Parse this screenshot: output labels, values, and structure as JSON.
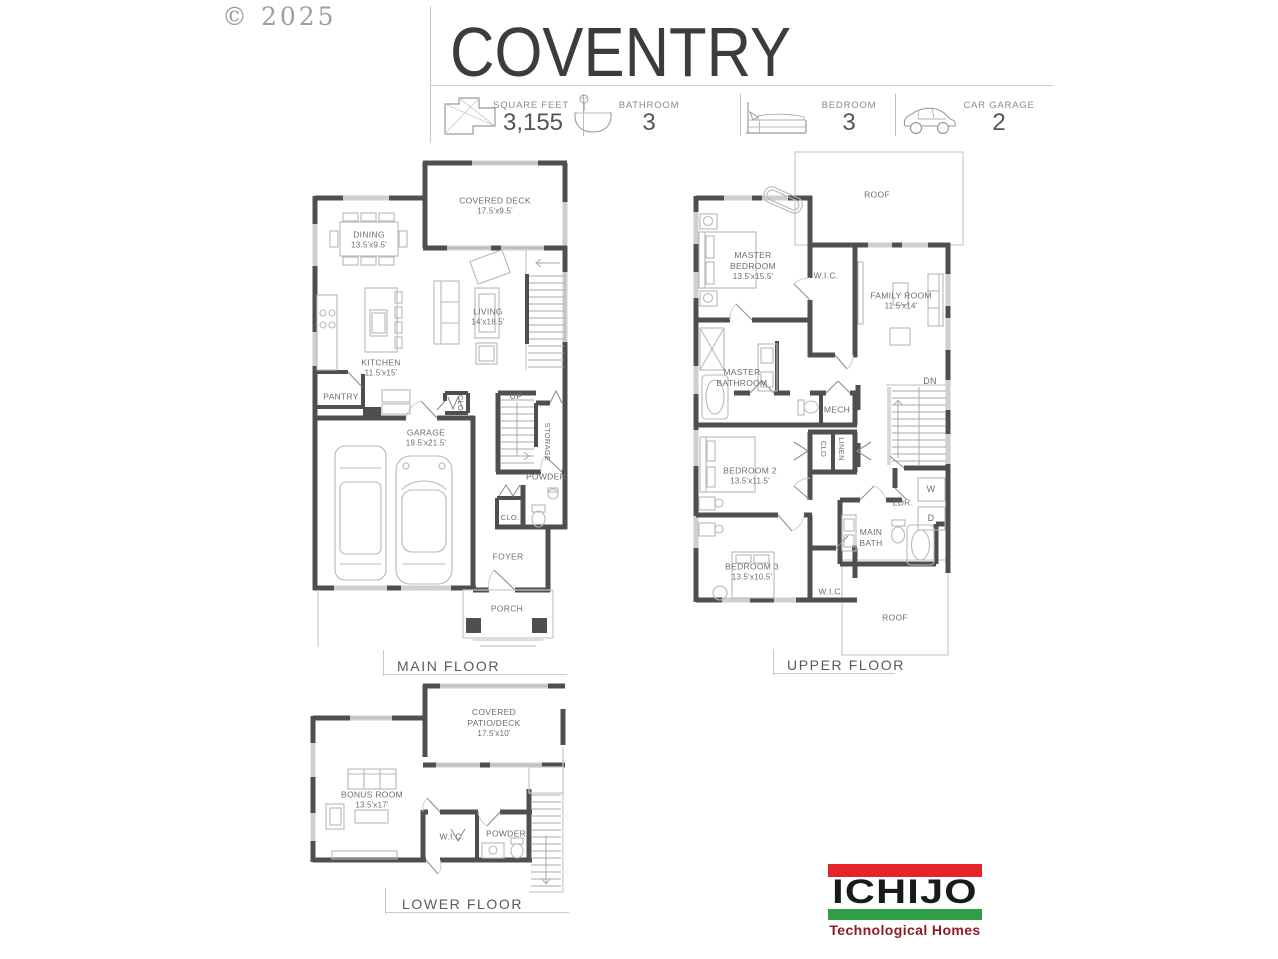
{
  "watermark": "© 2025",
  "header": {
    "title": "COVENTRY",
    "stats": [
      {
        "icon": "floorplan-icon",
        "label": "SQUARE FEET",
        "value": "3,155"
      },
      {
        "icon": "bathtub-icon",
        "label": "BATHROOM",
        "value": "3"
      },
      {
        "icon": "bed-icon",
        "label": "BEDROOM",
        "value": "3"
      },
      {
        "icon": "car-garage-icon",
        "label": "CAR GARAGE",
        "value": "2"
      }
    ]
  },
  "floors": {
    "main": {
      "title": "MAIN FLOOR",
      "rooms": {
        "covered_deck": {
          "name": "COVERED DECK",
          "dims": "17.5'x9.5'"
        },
        "dining": {
          "name": "DINING",
          "dims": "13.5'x9.5'"
        },
        "living": {
          "name": "LIVING",
          "dims": "14'x18.5'"
        },
        "kitchen": {
          "name": "KITCHEN",
          "dims": "11.5'x15'"
        },
        "pantry": {
          "name": "PANTRY"
        },
        "garage": {
          "name": "GARAGE",
          "dims": "19.5'x21.5'"
        },
        "up": {
          "name": "UP"
        },
        "storage": {
          "name": "STORAGE"
        },
        "powder": {
          "name": "POWDER"
        },
        "closet_garage": {
          "name": "CLO"
        },
        "closet_foyer": {
          "name": "CLO."
        },
        "foyer": {
          "name": "FOYER"
        },
        "porch": {
          "name": "PORCH"
        }
      }
    },
    "upper": {
      "title": "UPPER FLOOR",
      "rooms": {
        "roof_upper": {
          "name": "ROOF"
        },
        "master_bedroom": {
          "name": "MASTER BEDROOM",
          "dims": "13.5'x15.5'"
        },
        "wic_master": {
          "name": "W.I.C."
        },
        "family_room": {
          "name": "FAMILY ROOM",
          "dims": "11.5'x14'"
        },
        "master_bathroom": {
          "name": "MASTER BATHROOM"
        },
        "mech": {
          "name": "MECH"
        },
        "dn": {
          "name": "DN"
        },
        "clo": {
          "name": "CLO"
        },
        "linen": {
          "name": "LINEN"
        },
        "bedroom2": {
          "name": "BEDROOM 2",
          "dims": "13.5'x11.5'"
        },
        "ldr": {
          "name": "LDR."
        },
        "washer": {
          "name": "W"
        },
        "dryer": {
          "name": "D"
        },
        "main_bath": {
          "name": "MAIN BATH"
        },
        "bedroom3": {
          "name": "BEDROOM 3",
          "dims": "13.5'x10.5'"
        },
        "wic_bedroom3": {
          "name": "W.I.C."
        },
        "roof_lower": {
          "name": "ROOF"
        }
      }
    },
    "lower": {
      "title": "LOWER FLOOR",
      "rooms": {
        "covered_patio": {
          "name": "COVERED PATIO/DECK",
          "dims": "17.5'x10'"
        },
        "bonus_room": {
          "name": "BONUS ROOM",
          "dims": "13.5'x17'"
        },
        "wic": {
          "name": "W.I.C."
        },
        "powder": {
          "name": "POWDER"
        }
      }
    }
  },
  "logo": {
    "brand": "ICHIJO",
    "tagline": "Technological Homes",
    "colors": {
      "red": "#E4232B",
      "green": "#2F9E48",
      "tagline_maroon": "#8D1B1F"
    }
  }
}
